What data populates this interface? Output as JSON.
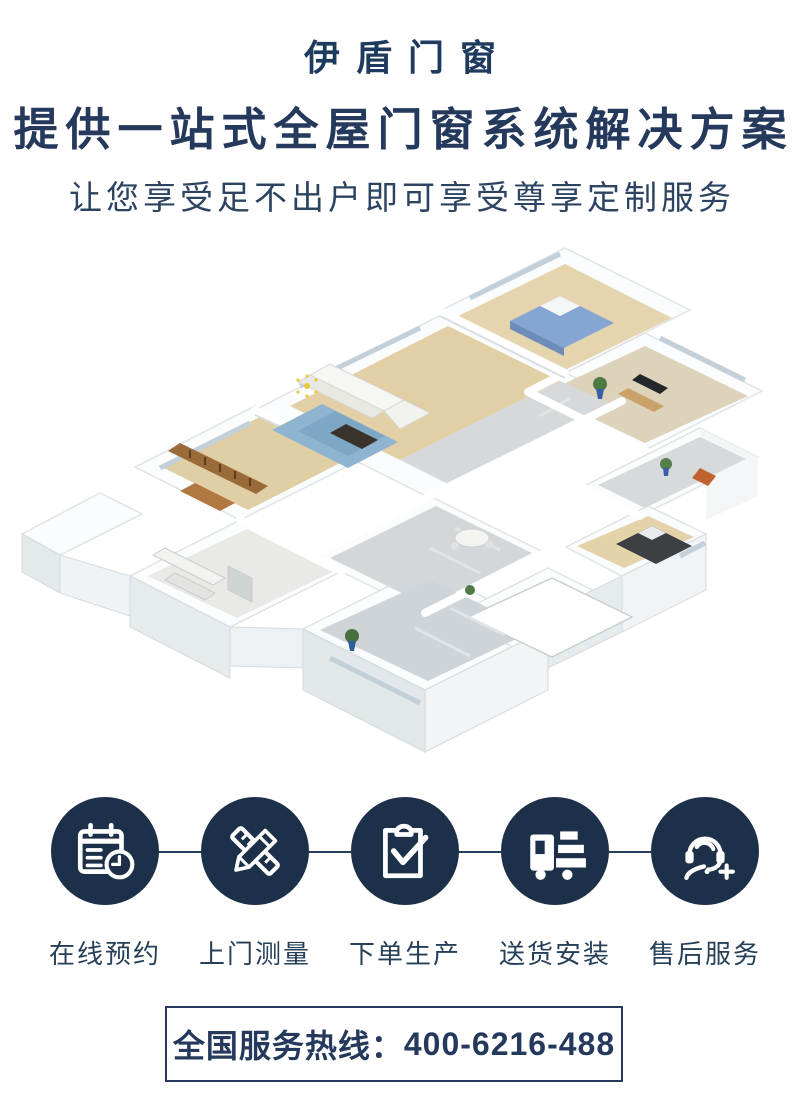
{
  "header": {
    "brand": "伊盾门窗",
    "headline": "提供一站式全屋门窗系统解决方案",
    "subheadline": "让您享受足不出户即可享受尊享定制服务",
    "text_color": "#1e3a5e"
  },
  "illustration": {
    "type": "isometric-floorplan",
    "description": "3D isometric cutaway render of a full apartment with living room, bedrooms, study, kitchen and bathrooms",
    "palette": {
      "wall_white": "#fbfcfd",
      "wall_shadow": "#e2e7ea",
      "floor_wood": "#e4d2aa",
      "floor_beige": "#ddd3ba",
      "floor_marble": "#d4d8db",
      "rug_blue": "#8fb4cf",
      "plant_green": "#4f7a46",
      "bed_blue": "#85a5d2",
      "furniture_wood": "#9a6a38"
    }
  },
  "services": {
    "circle_color": "#1d3049",
    "icon_color": "#ffffff",
    "items": [
      {
        "label": "在线预约",
        "icon": "calendar-clock-icon"
      },
      {
        "label": "上门测量",
        "icon": "pencil-ruler-icon"
      },
      {
        "label": "下单生产",
        "icon": "clipboard-check-icon"
      },
      {
        "label": "送货安装",
        "icon": "delivery-truck-icon"
      },
      {
        "label": "售后服务",
        "icon": "headset-plus-icon"
      }
    ]
  },
  "hotline": {
    "prefix": "全国服务热线：",
    "number": "400-6216-488"
  }
}
